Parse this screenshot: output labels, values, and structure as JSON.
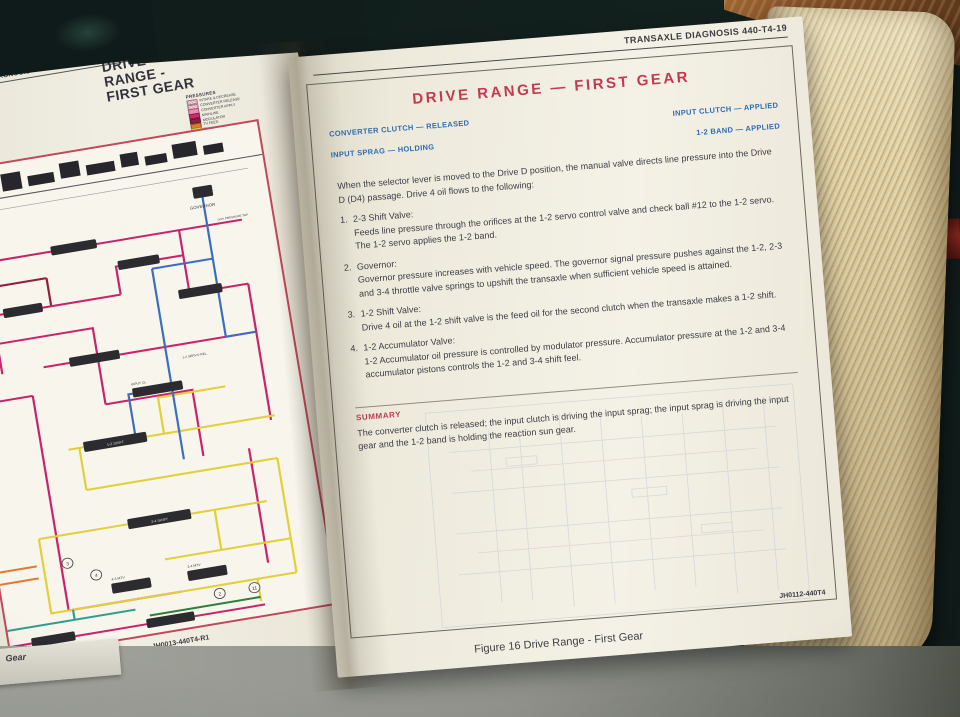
{
  "colors": {
    "title_red": "#c23a50",
    "label_blue": "#2e6cb3",
    "frame_red": "#c2475a",
    "mainline_magenta": "#c7246b",
    "tv_yellow": "#e3cf3a",
    "governor_blue": "#3a6fc0",
    "accumulator_teal": "#2e9e8e"
  },
  "left_page": {
    "edge_header": "E DIAGNOSIS",
    "title_line1": "DRIVE",
    "title_line2": "RANGE -",
    "title_line3": "FIRST GEAR",
    "legend": {
      "title": "PRESSURES",
      "entries": [
        {
          "label": "INTAKE & DECREASE",
          "color": "#eba4bd"
        },
        {
          "label": "CONVERTER RELEASE",
          "color": "#eba4bd"
        },
        {
          "label": "CONVERTER APPLY",
          "color": "#ef8fb0"
        },
        {
          "label": "MAINLINE",
          "color": "#cf2a72"
        },
        {
          "label": "MODULATOR",
          "color": "#8e2040"
        },
        {
          "label": "TV FEED",
          "color": "#e4782c"
        },
        {
          "label": "TV",
          "color": "#e6d23e"
        },
        {
          "label": "2-4 M T.V.",
          "color": "#e6d23e"
        },
        {
          "label": "3-4 M T.V.",
          "color": "#b8b832"
        },
        {
          "label": "GOVERNOR",
          "color": "#3a72c2"
        },
        {
          "label": "1-2 ACCUMULATOR",
          "color": "#2e9e8e"
        },
        {
          "label": "2-3 ACCUMULATOR",
          "color": "#2f7e3a"
        }
      ],
      "note": "*SOME MODELS"
    },
    "diagram": {
      "labels": {
        "governor": "GOVERNOR",
        "gov_tap": "GOV PRESSURE TAP",
        "shift_12": "1-2 SHIFT",
        "shift_34": "3-4 SHIFT",
        "mtv_43": "4-3 MTV",
        "mtv_24": "2-4 MTV",
        "input_cl": "INPUT CL.",
        "servo_rel": "1-2 SERVO REL."
      },
      "checkballs": [
        "3",
        "4",
        "2",
        "11"
      ]
    },
    "doc_number": "JH0013-440T4-R1",
    "corner_text": "Gear"
  },
  "right_page": {
    "page_header": "TRANSAXLE DIAGNOSIS  440-T4-19",
    "title": "DRIVE RANGE — FIRST GEAR",
    "statuses": {
      "left": [
        "CONVERTER CLUTCH — RELEASED",
        "INPUT SPRAG — HOLDING"
      ],
      "right": [
        "INPUT CLUTCH — APPLIED",
        "1-2 BAND — APPLIED"
      ]
    },
    "intro": "When the selector lever is moved to the Drive D position, the manual valve directs line pressure into the Drive D (D4) passage. Drive 4 oil flows to the following:",
    "items": [
      {
        "num": "1.",
        "heading": "2-3 Shift Valve:",
        "body": "Feeds line pressure through the orifices at the 1-2 servo control valve and check ball #12 to the 1-2 servo. The 1-2 servo applies the 1-2 band."
      },
      {
        "num": "2.",
        "heading": "Governor:",
        "body": "Governor pressure increases with vehicle speed. The governor signal pressure pushes against the 1-2, 2-3 and 3-4 throttle valve springs to upshift the transaxle when sufficient vehicle speed is attained."
      },
      {
        "num": "3.",
        "heading": "1-2 Shift Valve:",
        "body": "Drive 4 oil at the 1-2 shift valve is the feed oil for the second clutch when the transaxle makes a 1-2 shift."
      },
      {
        "num": "4.",
        "heading": "1-2 Accumulator Valve:",
        "body": "1-2 Accumulator oil pressure is controlled by modulator pressure. Accumulator pressure at the 1-2 and 3-4 accumulator pistons controls the 1-2 and 3-4 shift feel."
      }
    ],
    "summary_heading": "SUMMARY",
    "summary_body": "The converter clutch is released; the input clutch is driving the input sprag; the input sprag is driving the input gear and the 1-2 band is holding the reaction sun gear.",
    "doc_number": "JH0112-440T4",
    "figure_caption": "Figure 16 Drive Range - First Gear"
  }
}
